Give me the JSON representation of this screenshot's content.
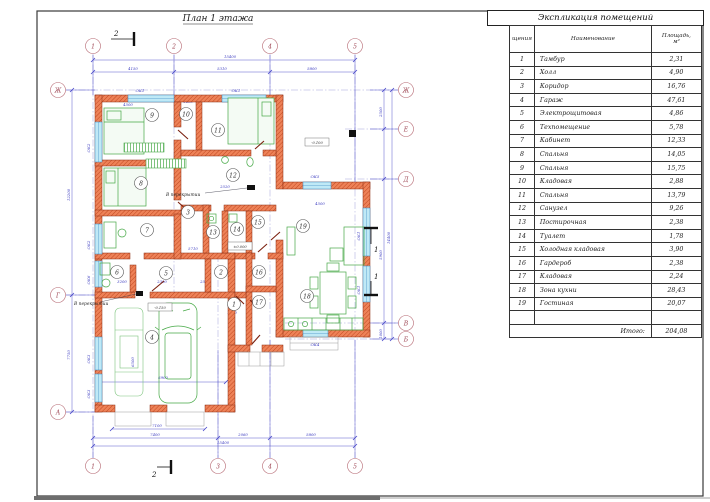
{
  "sheet": {
    "title": "План 1 этажа"
  },
  "axes": {
    "top": [
      "1",
      "2",
      "4",
      "5"
    ],
    "bottom": [
      "1",
      "3",
      "4",
      "5"
    ],
    "left": [
      "Ж",
      "Г",
      "А"
    ],
    "right": [
      "Ж",
      "Е",
      "Д",
      "В",
      "Б"
    ]
  },
  "rooms": [
    "1",
    "2",
    "3",
    "4",
    "5",
    "6",
    "7",
    "8",
    "9",
    "10",
    "11",
    "12",
    "13",
    "14",
    "15",
    "16",
    "17",
    "18",
    "19"
  ],
  "windows": {
    "t1": "ОК1",
    "t2": "ОК1",
    "l1": "ОК2",
    "l2": "ОК2",
    "l3": "ОК6",
    "l4": "ОК3",
    "l5": "ОК3",
    "r1": "ОК1",
    "r2": "ОК1",
    "ok5": "ОК5",
    "ok4": "ОК4"
  },
  "dims": {
    "top_total": "15400",
    "top_1": "4150",
    "top_2": "5310",
    "top_3": "5800",
    "bot_doors": "7100",
    "bot_1": "7400",
    "bot_2": "2060",
    "bot_3": "5800",
    "bot_total": "15400",
    "left_1": "12200",
    "left_2": "7750",
    "right_1": "2500",
    "right_2": "5900",
    "right_3": "1000",
    "right_total": "14400",
    "in_1": "4500",
    "in_2": "1400",
    "in_3": "3940",
    "in_4": "2520",
    "in_5": "5710",
    "in_6": "3200",
    "in_7": "2300",
    "in_8": "2550",
    "in_9": "6900",
    "in_10": "6500",
    "in_11": "4500",
    "in_12": "1540"
  },
  "labels": {
    "ceiling_1": "В перекрытии",
    "ceiling_2": "В перекрытии",
    "lvl_zero": "±0.000",
    "lvl_garage": "-0.150",
    "lvl_terrace": "-0.100",
    "sec_2a": "2",
    "sec_2b": "2",
    "sec_1a": "1",
    "sec_1b": "1"
  },
  "table": {
    "title": "Экспликация помещений",
    "col_no": "щения",
    "col_name": "Наименование",
    "col_area_1": "Площадь,",
    "col_area_2": "м²",
    "rows": [
      {
        "no": "1",
        "name": "Тамбур",
        "area": "2,31"
      },
      {
        "no": "2",
        "name": "Холл",
        "area": "4,90"
      },
      {
        "no": "3",
        "name": "Коридор",
        "area": "16,76"
      },
      {
        "no": "4",
        "name": "Гараж",
        "area": "47,61"
      },
      {
        "no": "5",
        "name": "Электрощитовая",
        "area": "4,86"
      },
      {
        "no": "6",
        "name": "Техпомещение",
        "area": "5,78"
      },
      {
        "no": "7",
        "name": "Кабинет",
        "area": "12,33"
      },
      {
        "no": "8",
        "name": "Спальня",
        "area": "14,05"
      },
      {
        "no": "9",
        "name": "Спальня",
        "area": "15,75"
      },
      {
        "no": "10",
        "name": "Кладовая",
        "area": "2,88"
      },
      {
        "no": "11",
        "name": "Спальня",
        "area": "13,79"
      },
      {
        "no": "12",
        "name": "Санузел",
        "area": "9,26"
      },
      {
        "no": "13",
        "name": "Постирочная",
        "area": "2,38"
      },
      {
        "no": "14",
        "name": "Туалет",
        "area": "1,78"
      },
      {
        "no": "15",
        "name": "Холодная кладовая",
        "area": "3,90"
      },
      {
        "no": "16",
        "name": "Гардероб",
        "area": "2,38"
      },
      {
        "no": "17",
        "name": "Кладовая",
        "area": "2,24"
      },
      {
        "no": "18",
        "name": "Зона кухни",
        "area": "28,43"
      },
      {
        "no": "19",
        "name": "Гостиная",
        "area": "20,07"
      }
    ],
    "total_label": "Итого:",
    "total_value": "204,08"
  }
}
